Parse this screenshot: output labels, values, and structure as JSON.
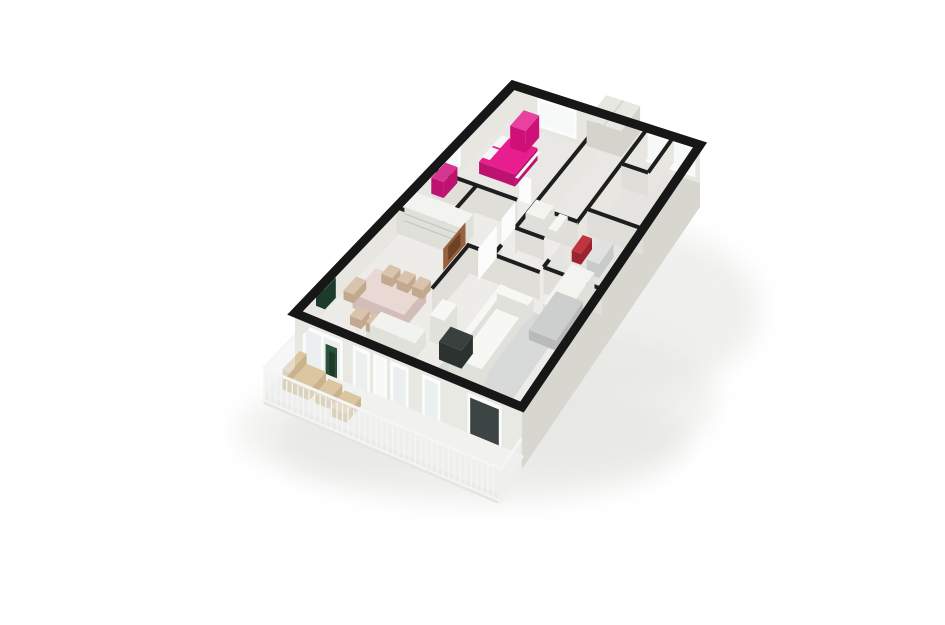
{
  "scene": {
    "description": "3D isometric rendering of an apartment floor plan on a white background",
    "view": "bird's-eye 3D cutaway, walls capped in black",
    "rooms": [
      {
        "name": "bedroom",
        "furniture": [
          "double-bed",
          "wardrobe"
        ]
      },
      {
        "name": "hallway",
        "furniture": [
          "closet"
        ]
      },
      {
        "name": "second-bedroom",
        "furniture": []
      },
      {
        "name": "bathroom",
        "furniture": [
          "sink-counter",
          "toilet"
        ]
      },
      {
        "name": "laundry-room",
        "furniture": [
          "laundry-basket",
          "washing-machine"
        ]
      },
      {
        "name": "storage-room",
        "furniture": [
          "pink-dresser"
        ]
      },
      {
        "name": "living-room",
        "furniture": [
          "sofa",
          "rug",
          "bookshelf",
          "sideboard",
          "tv-cabinet",
          "artwork",
          "plant",
          "tall-cabinet"
        ]
      },
      {
        "name": "dining-area",
        "furniture": [
          "dining-table",
          "dining-chairs"
        ]
      },
      {
        "name": "kitchen-corner",
        "furniture": [
          "counter"
        ]
      },
      {
        "name": "balcony",
        "furniture": [
          "lounge-chair",
          "wooden-stool",
          "wooden-stool"
        ],
        "enclosure": "glass-balustrade"
      }
    ]
  },
  "colors": {
    "background": "#ffffff",
    "shadow": "#e3e3e0",
    "wall_cap": "#171717",
    "interior_wall_cap": "#1e1e1e",
    "exterior_right": "#d7d6cf",
    "exterior_front": "#e9e9e4",
    "fascia": "#e6e6e1",
    "floor": "#edece8",
    "wall_face": "#dfded8",
    "wall_face_light": "#e7e6e0",
    "window_frame": "#fbfcfb",
    "window_glass": "#eceff0",
    "window_glass_bright": "#f7f9f9",
    "window_glass_dark": "#3c4543",
    "bed_blanket": "#e91e8e",
    "bed_dark": "#bd1270",
    "pillow": "#f6f6f6",
    "wardrobe_side": "#cf1079",
    "wardrobe_top": "#e8419e",
    "closet": "#e8e8e3",
    "closet_side": "#d4d4cd",
    "dresser_pink": "#d6368f",
    "red_item": "#c23340",
    "red_item_dark": "#9c2431",
    "washer": "#e0e2e2",
    "washer_side": "#c8cbca",
    "shelf": "#f3f3f0",
    "shelf_side": "#e0e0da",
    "shelf_line": "#c6c6c0",
    "table_top": "#e9d8d4",
    "table_side": "#d2bdb8",
    "chair_tan": "#d9c3ad",
    "chair_side": "#c2a98e",
    "couch": "#f7f7f4",
    "couch_side": "#e1e1db",
    "rug": "#d8dad9",
    "gray_piece": "#cdcfce",
    "gray_piece_side": "#b9bbba",
    "kitchen": "#f2f2ee",
    "art_brown": "#96613e",
    "art_dark": "#6e4227",
    "plant": "#2a523b",
    "plant_dark": "#1d3b2a",
    "balcony_floor": "#f1f1ed",
    "railing": "#f5f6f4",
    "railing_glass": "#eef0ee",
    "wood_tan": "#dcc6a2",
    "wood_side": "#c9b28c",
    "tv_dark": "#39413f",
    "tv_dark_side": "#2b3230"
  }
}
